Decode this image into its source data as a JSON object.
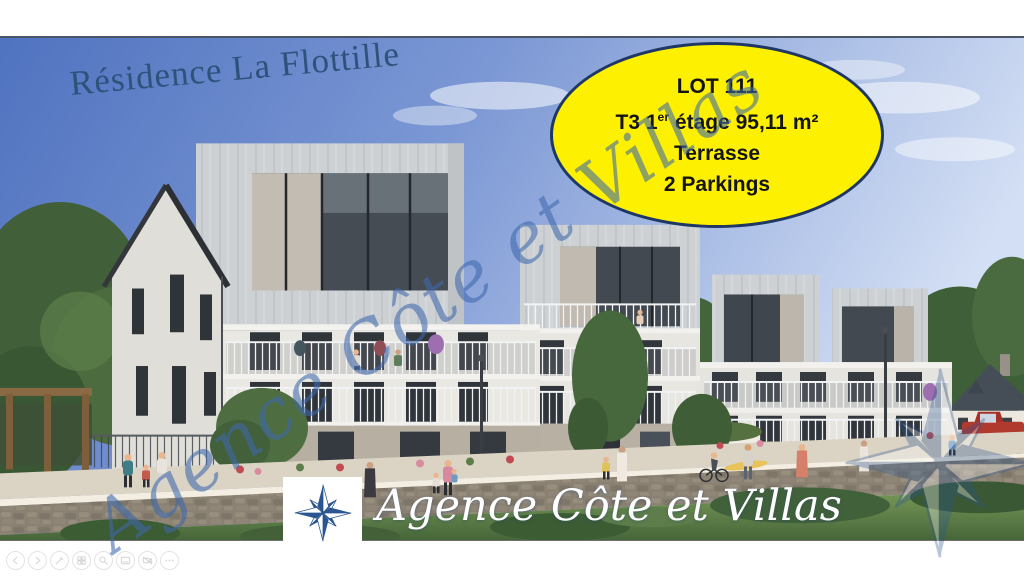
{
  "slide": {
    "title": "Résidence La Flottille",
    "badge": {
      "line1": "LOT 111",
      "line2_pre": "T3 1",
      "line2_sup": "er",
      "line2_post": " étage 95,11 m²",
      "line3": "Terrasse",
      "line4": "2 Parkings"
    },
    "diagonal_watermark": "Agence Côte et Villas",
    "agency": {
      "name": "Agence Côte et Villas"
    },
    "scene_description": "Architectural rendering of a modern seaside apartment residence with balconies, pedestrians, trees and a red pickup truck"
  },
  "css_vars": {
    "title-color": "#2e537b",
    "badge-bg": "#fdf101",
    "badge-border": "#1e3765",
    "badge-text": "#141414",
    "watermark-color": "rgba(62,104,173,0.58)",
    "script-white": "#ffffff",
    "logo-blue": "#2b5591",
    "sky-left": "#5073c0",
    "sky-right": "#d3dff4"
  },
  "viewer_toolbar": {
    "buttons": [
      {
        "name": "previous-slide"
      },
      {
        "name": "next-slide"
      },
      {
        "name": "pen-tools"
      },
      {
        "name": "see-all-slides"
      },
      {
        "name": "zoom-slide"
      },
      {
        "name": "toggle-subtitles"
      },
      {
        "name": "toggle-camera"
      },
      {
        "name": "more-options"
      }
    ]
  }
}
